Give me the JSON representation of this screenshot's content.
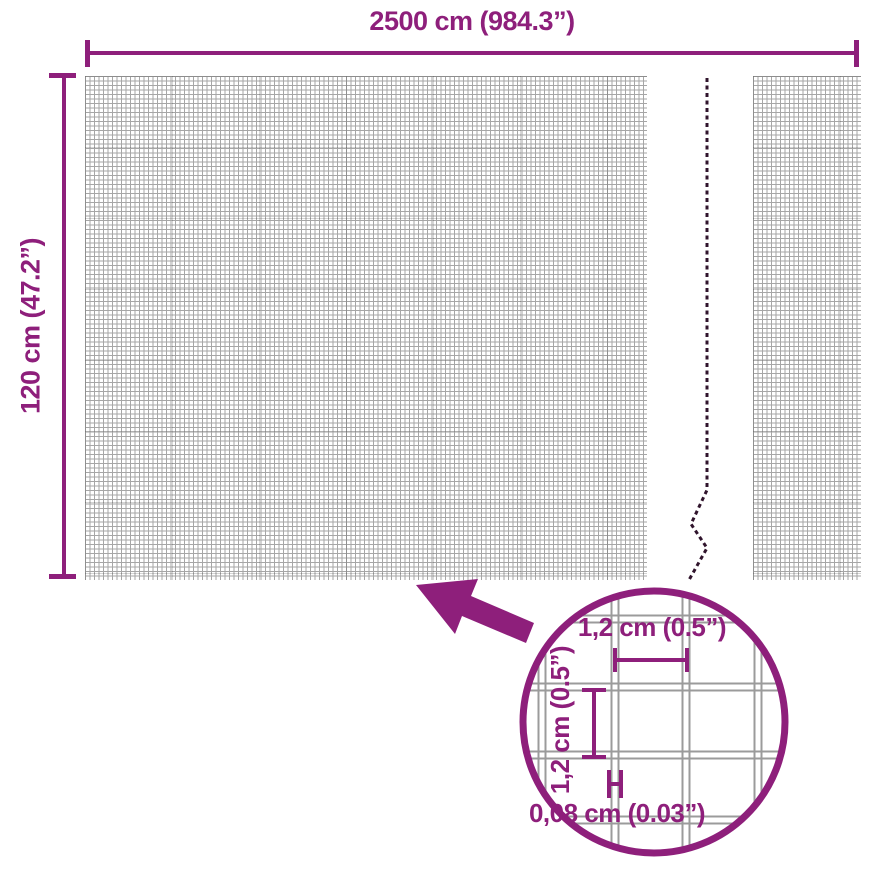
{
  "colors": {
    "accent": "#8E1F7B",
    "mesh_line": "#A6A6A6",
    "break_line": "#30142C",
    "magnifier_grid": "#9B9B9B"
  },
  "overall_dimensions": {
    "width_label": "2500 cm (984.3”)",
    "height_label": "120 cm (47.2”)"
  },
  "magnifier": {
    "cell_width_label": "1,2 cm (0.5”)",
    "cell_height_label": "1,2 cm (0.5”)",
    "wire_thickness_label": "0,08 cm (0.03”)"
  }
}
